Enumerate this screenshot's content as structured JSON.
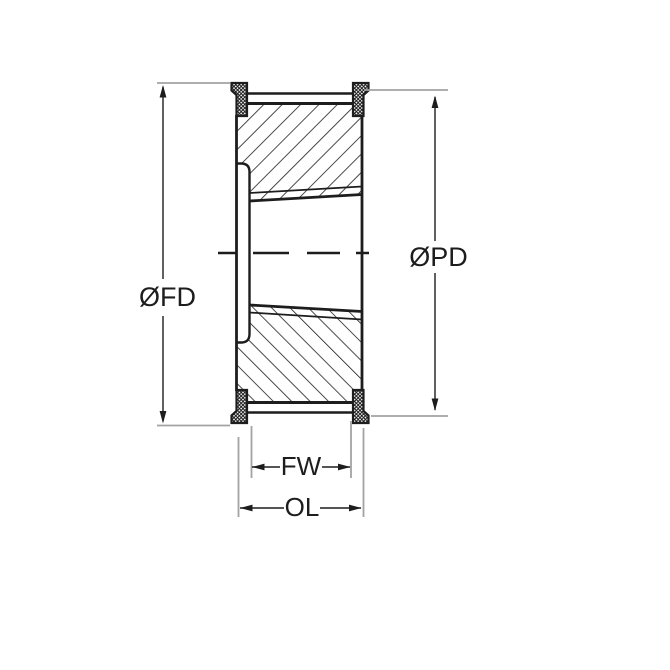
{
  "dimensions": {
    "flange_diameter": {
      "symbol": "ØFD"
    },
    "pitch_diameter": {
      "symbol": "ØPD"
    },
    "face_width": {
      "symbol": "FW"
    },
    "overall_length": {
      "symbol": "OL"
    }
  },
  "colors": {
    "line": "#1d1d1d",
    "extension_line": "#a3a3a3",
    "background": "#ffffff"
  }
}
